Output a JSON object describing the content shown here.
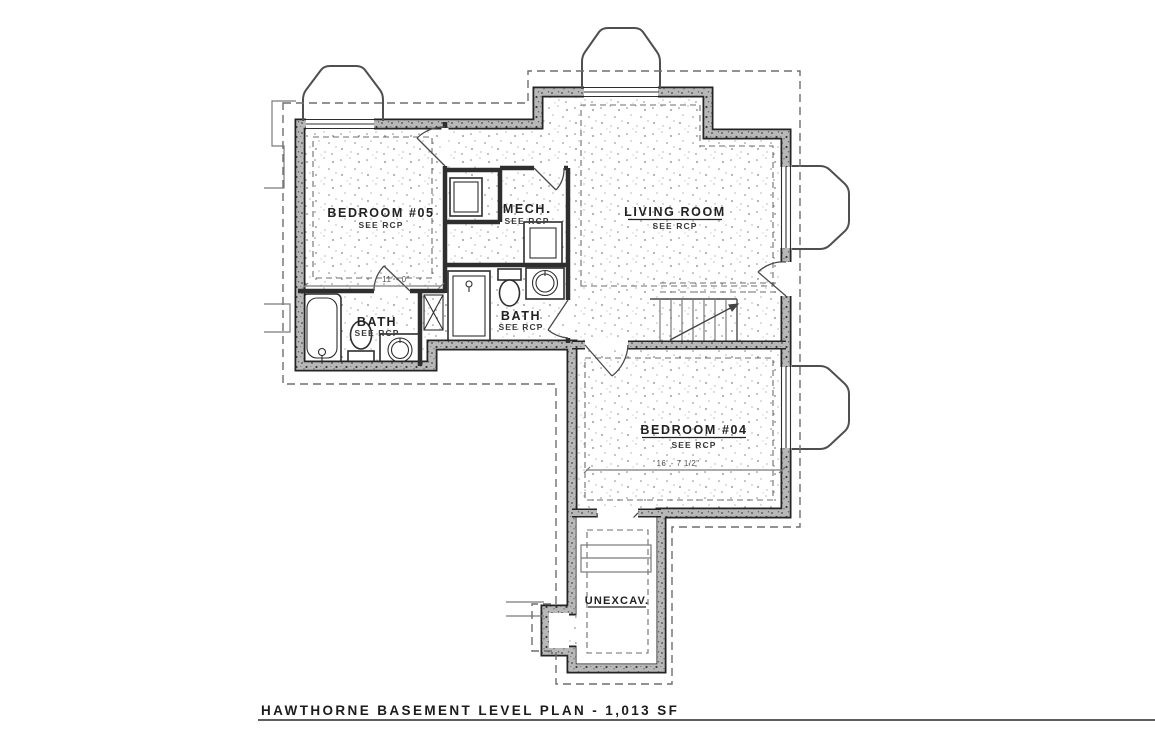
{
  "drawing": {
    "title": "HAWTHORNE BASEMENT LEVEL PLAN - 1,013 SF",
    "rooms": {
      "bedroom05": {
        "name": "BEDROOM #05",
        "note": "SEE RCP"
      },
      "mech": {
        "name": "MECH.",
        "note": "SEE RCP"
      },
      "living_room": {
        "name": "LIVING ROOM",
        "note": "SEE RCP"
      },
      "bath_left": {
        "name": "BATH",
        "note": "SEE RCP"
      },
      "bath_center": {
        "name": "BATH",
        "note": "SEE RCP"
      },
      "bedroom04": {
        "name": "BEDROOM #04",
        "note": "SEE RCP"
      },
      "unexcavated": {
        "name": "UNEXCAV."
      }
    },
    "dimensions": {
      "bedroom05_width": "11' - 0\"",
      "bedroom04_width": "16' - 7 1/2\""
    },
    "colors": {
      "ink": "#2d2d2d",
      "wall_gray": "#b8b8b8",
      "dash_gray": "#6e6e6e",
      "paper": "#ffffff"
    }
  }
}
